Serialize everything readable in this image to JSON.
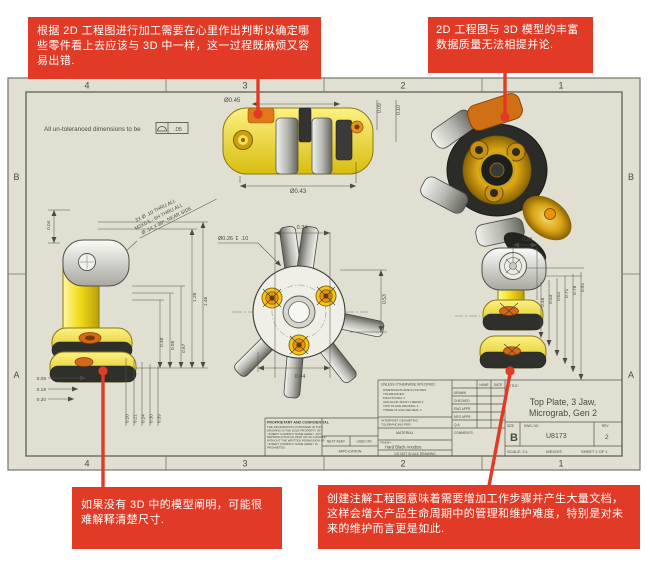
{
  "colors": {
    "callout_red": "#e13b28",
    "sheet_background": "#e0dfd1",
    "part_yellow": "#f4dc1c",
    "part_orange": "#e07818",
    "drawing_line": "#4a4a42"
  },
  "callouts": {
    "top_left": "根据 2D 工程图进行加工需要在心里作出判断以确定哪些零件看上去应该与 3D 中一样，这一过程既麻烦又容易出错.",
    "top_right": "2D 工程图与 3D 模型的丰富数据质量无法相提并论.",
    "bottom_left": "如果没有 3D 中的模型阐明，可能很难解释清楚尺寸.",
    "bottom_right": "创建注解工程图意味着需要增加工作步骤并产生大量文档，这样会增大产品生命周期中的管理和维护难度，特别是对未来的维护而言更是如此."
  },
  "sheet": {
    "zones_h": [
      "4",
      "3",
      "2",
      "1"
    ],
    "zones_v": [
      "B",
      "A"
    ],
    "note_prefix": "All un-toleranced dimensions to be",
    "note_value": ".05"
  },
  "dims": {
    "top_view": {
      "dia_top": "Ø0.45",
      "dia_bottom": "Ø0.43",
      "r1": "0.09",
      "r2": "0.10"
    },
    "left_view": {
      "top": "0.04",
      "callout1": "3X Ø .10 THRU ALL",
      "callout2": "M3X0.5 - 6H THRU ALL",
      "callout3": "Ø .14 X 90°, NEAR SIDE",
      "right": [
        "0.48",
        "0.59",
        "0.67",
        "1.28",
        "1.46"
      ],
      "left": [
        "0.08",
        "0.19",
        "0.20"
      ],
      "bottom": [
        "0.20",
        "0.21",
        "0.24",
        "0.30",
        "0.39"
      ]
    },
    "plan_view": {
      "top": "0.34",
      "cbore": "Ø0.26 ↧ .10",
      "right": "0.53",
      "bottom": "0.44"
    },
    "right_view": {
      "top": "0.20",
      "right": [
        "0.48",
        "0.53",
        "0.61",
        "0.71",
        "0.78",
        "0.91"
      ]
    }
  },
  "title_block": {
    "unless": "UNLESS OTHERWISE SPECIFIED:",
    "tol_lines": [
      "DIMENSIONS ARE IN INCHES",
      "TOLERANCES:",
      "FRACTIONAL ±",
      "ANGULAR: MACH ±  BEND ±",
      "TWO PLACE DECIMAL    ±",
      "THREE PLACE DECIMAL  ±"
    ],
    "interpret_lines": [
      "INTERPRET GEOMETRIC",
      "TOLERANCING PER:"
    ],
    "material_label": "MATERIAL",
    "finish_label": "FINISH",
    "finish_value": "Hard Black Anodize",
    "do_not_scale": "DO NOT SCALE DRAWING",
    "name_header": "NAME",
    "date_header": "DATE",
    "approval_rows": [
      "DRAWN",
      "CHECKED",
      "ENG APPR.",
      "MFG APPR.",
      "Q.A.",
      "COMMENTS:"
    ],
    "title_label": "TITLE:",
    "title_line1": "Top Plate, 3 Jaw,",
    "title_line2": "Micrograb, Gen 2",
    "size_label": "SIZE",
    "size_value": "B",
    "dwg_label": "DWG.  NO.",
    "dwg_value": "U8173",
    "rev_label": "REV",
    "rev_value": "2",
    "scale": "SCALE: 2:1",
    "weight": "WEIGHT:",
    "sheet_of": "SHEET 1 OF 1",
    "proprietary_title": "PROPRIETARY AND CONFIDENTIAL",
    "proprietary_lines": [
      "THE INFORMATION CONTAINED IN THIS",
      "DRAWING IS THE SOLE PROPERTY OF",
      "<INSERT COMPANY NAME HERE>. ANY",
      "REPRODUCTION IN PART OR AS A WHOLE",
      "WITHOUT THE WRITTEN PERMISSION OF",
      "<INSERT COMPANY NAME HERE> IS",
      "PROHIBITED."
    ],
    "next_assy": "NEXT ASSY",
    "used_on": "USED ON",
    "application": "APPLICATION"
  }
}
